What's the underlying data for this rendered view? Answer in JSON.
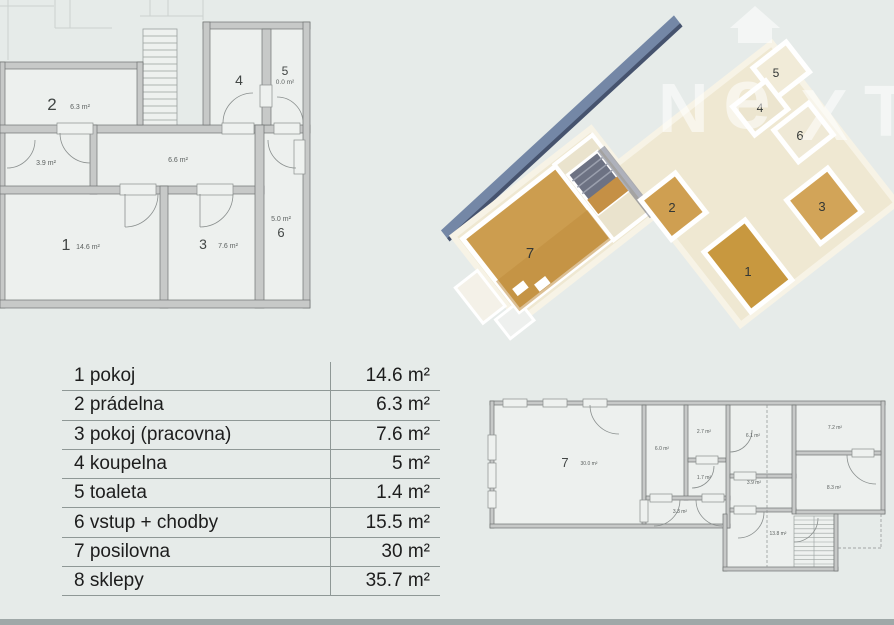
{
  "page": {
    "background": "#e6ebe9",
    "bottom_bar_color": "#9fa8a8"
  },
  "watermark": {
    "letters": [
      "N",
      "e",
      "X",
      "T"
    ]
  },
  "legend": {
    "rows": [
      {
        "name": "1 pokoj",
        "area": "14.6 m²"
      },
      {
        "name": "2 prádelna",
        "area": "6.3 m²"
      },
      {
        "name": "3 pokoj (pracovna)",
        "area": "7.6 m²"
      },
      {
        "name": "4 koupelna",
        "area": "5 m²"
      },
      {
        "name": "5 toaleta",
        "area": "1.4 m²"
      },
      {
        "name": "6 vstup + chodby",
        "area": "15.5 m²"
      },
      {
        "name": "7 posilovna",
        "area": "30 m²"
      },
      {
        "name": "8 sklepy",
        "area": "35.7 m²"
      }
    ]
  },
  "plan_upper": {
    "room1": {
      "num": "1",
      "area": "14.6 m²"
    },
    "room2": {
      "num": "2",
      "area": "6.3 m²"
    },
    "room3": {
      "num": "3",
      "area": "7.6 m²"
    },
    "room4": {
      "num": "4"
    },
    "room5": {
      "num": "5",
      "area": "0.0 m²"
    },
    "room6": {
      "num": "6",
      "area": "5.0 m²"
    },
    "hall": {
      "area": "6.6 m²"
    },
    "vestibule": {
      "area": "3.9 m²"
    }
  },
  "render3d": {
    "labels": {
      "r1": "1",
      "r2": "2",
      "r3": "3",
      "r4": "4",
      "r5": "5",
      "r6": "6",
      "r7": "7"
    }
  },
  "plan_lower": {
    "room7": {
      "num": "7",
      "area": "30.0 m²"
    },
    "areas": {
      "a60": "6.0 m²",
      "a27": "2.7 m²",
      "a17": "1.7 m²",
      "a61": "6.1 m²",
      "a39": "3.9 m²",
      "a72": "7.2 m²",
      "a83": "8.3 m²",
      "a33": "3.3 m²",
      "a138": "13.8 m²"
    }
  }
}
